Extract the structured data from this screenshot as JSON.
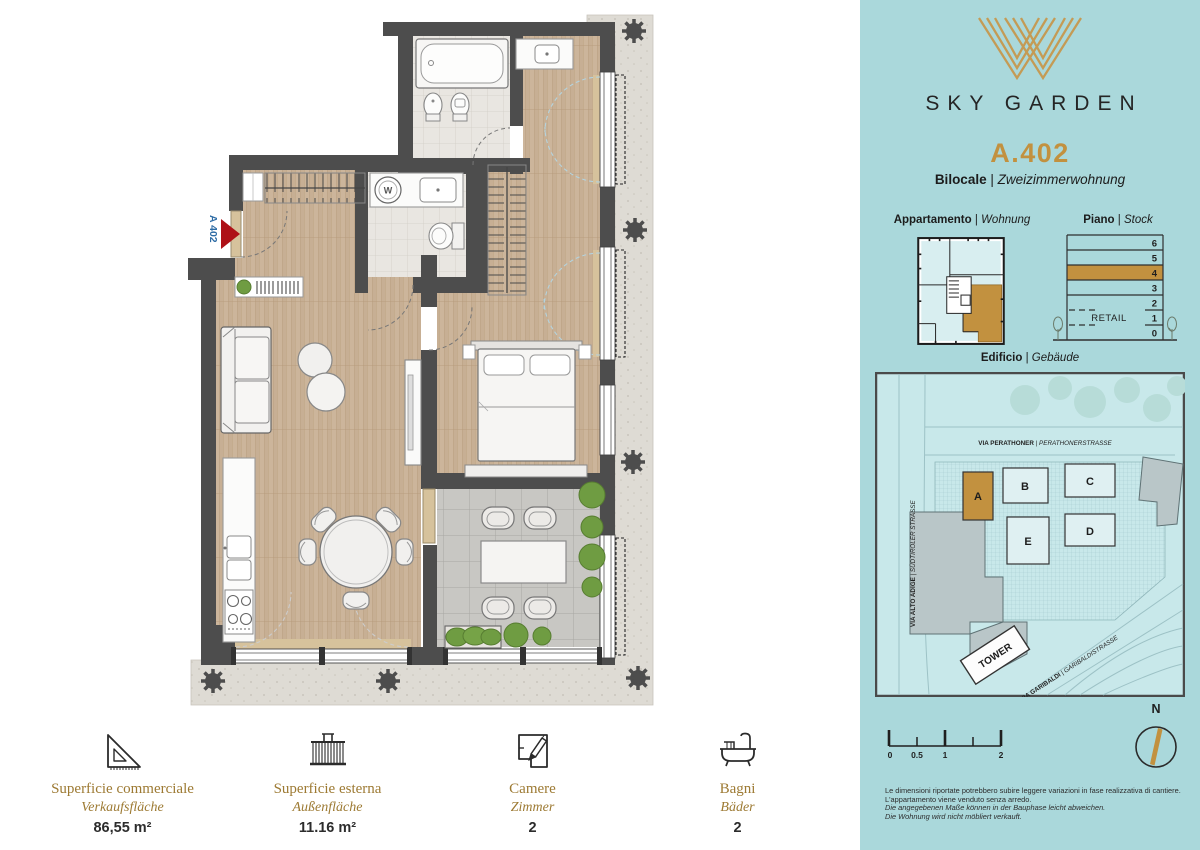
{
  "page": {
    "bg": "#ffffff",
    "accent_gold": "#c2913f",
    "panel_teal": "#aad8db"
  },
  "brand": {
    "logo_icon": "sky-garden-monogram-icon",
    "name": "SKY GARDEN"
  },
  "unit": {
    "code": "A.402",
    "type_it": "Bilocale",
    "type_de": "Zweizimmerwohnung",
    "divider": "|"
  },
  "sections": {
    "apartment": {
      "label_it": "Appartamento",
      "label_de": "Wohnung"
    },
    "floor": {
      "label_it": "Piano",
      "label_de": "Stock"
    },
    "building": {
      "label_it": "Edificio",
      "label_de": "Gebäude"
    }
  },
  "floor_stack": {
    "levels": [
      "6",
      "5",
      "4",
      "3",
      "2",
      "1",
      "0"
    ],
    "highlighted": "4",
    "retail_label": "RETAIL"
  },
  "site_map": {
    "streets": [
      {
        "it": "VIA PERATHONER",
        "de": "PERATHONERSTRASSE"
      },
      {
        "it": "VIA ALTO ADIGE",
        "de": "SÜDTIROLER STRASSE"
      },
      {
        "it": "VIA GARIBALDI",
        "de": "GARIBALDISTRASSE"
      }
    ],
    "buildings": [
      "A",
      "B",
      "C",
      "D",
      "E"
    ],
    "highlighted_building": "A",
    "tower_label": "TOWER"
  },
  "scale_bar": {
    "labels": [
      "0",
      "0.5",
      "1",
      "2"
    ]
  },
  "compass": {
    "label": "N"
  },
  "disclaimer": {
    "lines": [
      "Le dimensioni riportate potrebbero subire leggere variazioni in fase realizzativa di cantiere.",
      "L'appartamento viene venduto senza arredo.",
      "Die angegebenen Maße können in der Bauphase leicht abweichen.",
      "Die Wohnung wird nicht möbliert verkauft."
    ]
  },
  "floor_plan": {
    "unit_marker": "A 402",
    "washer_label": "W"
  },
  "stats": [
    {
      "icon": "set-square-icon",
      "label_it": "Superficie commerciale",
      "label_de": "Verkaufsfläche",
      "value": "86,55 m²"
    },
    {
      "icon": "balcony-icon",
      "label_it": "Superficie esterna",
      "label_de": "Außenfläche",
      "value": "11.16 m²"
    },
    {
      "icon": "rooms-plan-icon",
      "label_it": "Camere",
      "label_de": "Zimmer",
      "value": "2"
    },
    {
      "icon": "bathtub-icon",
      "label_it": "Bagni",
      "label_de": "Bäder",
      "value": "2"
    }
  ]
}
